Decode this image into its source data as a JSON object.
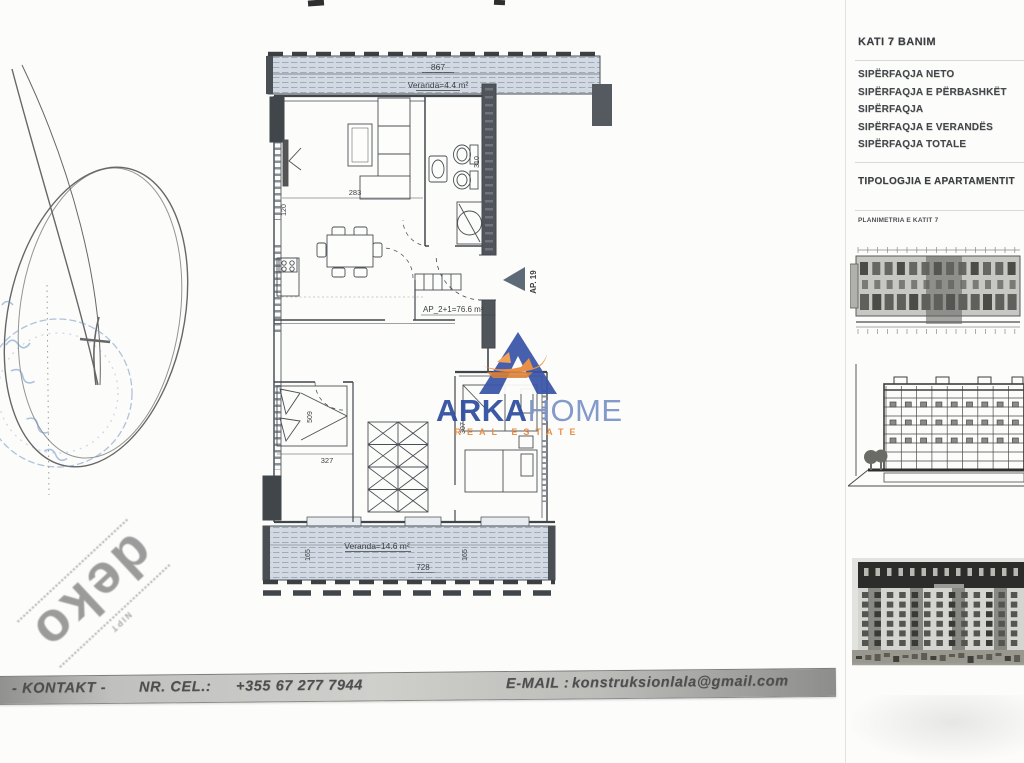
{
  "right_panel": {
    "floor_title": "KATI 7 BANIM",
    "rows": [
      "SIPËRFAQJA NETO",
      "SIPËRFAQJA E PËRBASHKËT",
      "SIPËRFAQJA",
      "SIPËRFAQJA E VERANDËS",
      "SIPËRFAQJA  TOTALE"
    ],
    "typology_title": "TIPOLOGJIA E APARTAMENTIT",
    "keyplan_title": "PLANIMETRIA E KATIT 7"
  },
  "floor_plan": {
    "apartment_id": "AP. 19",
    "apartment_area": "AP_2+1=76.6 m²",
    "veranda_top_label": "Veranda=4.4 m²",
    "veranda_bottom_label": "Veranda=14.6 m²",
    "dimensions": {
      "veranda_top_width": "867",
      "living_width": "283",
      "living_depth": "120",
      "bath_depth": "310",
      "bed_depth": "509",
      "bed_width": "327",
      "room2_depth": "307",
      "veranda_bottom_width": "728",
      "veranda_bottom_depth": "165"
    }
  },
  "logo": {
    "name_primary": "ARKA",
    "name_secondary": "HOME",
    "tagline": "REAL ESTATE"
  },
  "stamp": {
    "small_text": "NIPT",
    "big_text": "deko"
  },
  "contact_bar": {
    "label_kontakt": "- KONTAKT -",
    "label_cel": "NR. CEL.:",
    "phone": "+355 67 277 7944",
    "label_email": "E-MAIL :",
    "email": "konstruksionlala@gmail.com"
  },
  "colors": {
    "logo_blue": "#2d4d9e",
    "logo_light_blue": "#7b93c8",
    "logo_orange": "#e8883a",
    "plan_line": "#41464b",
    "veranda_fill": "#d2d8e1",
    "bar_gray": "#bcbcb9"
  }
}
